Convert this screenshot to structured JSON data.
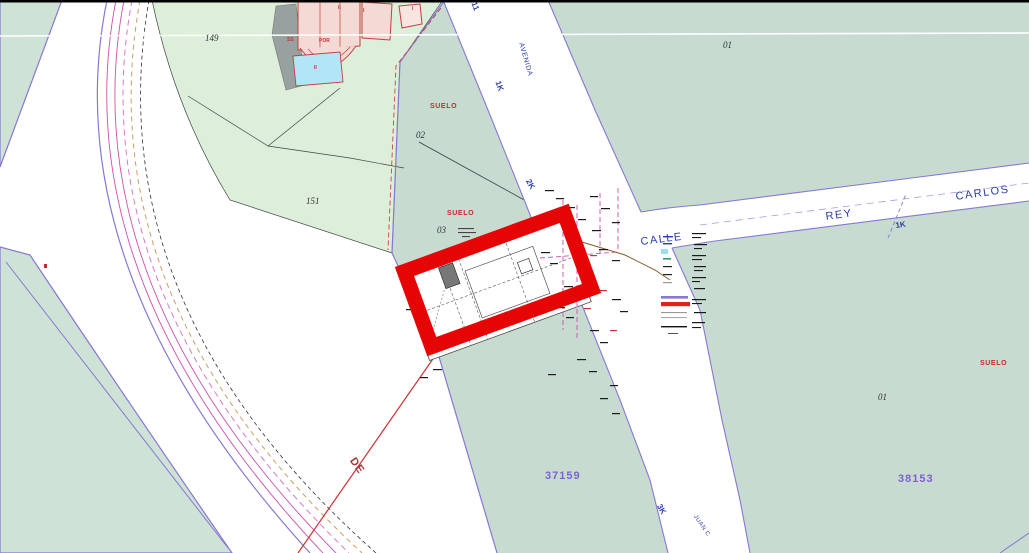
{
  "labels": {
    "p149": "149",
    "p151": "151",
    "p02": "02",
    "p03": "03",
    "p01_top": "01",
    "p01_bottom": "01",
    "suelo_top": "SUELO",
    "suelo_mid": "SUELO",
    "suelo_right": "SUELO",
    "ref_bottom_center": "37159",
    "ref_bottom_right": "38153",
    "avenida": "AVENIDA",
    "calle": "CALLE",
    "rey": "REY",
    "carlos": "CARLOS",
    "de": "DE",
    "juan_c": "JUAN C",
    "k1_avenida": "1K",
    "k1_rey": "1K",
    "k2": "2K",
    "k3": "3K",
    "k11": "11",
    "b_ss": "SS",
    "b_por": "POR",
    "b_ii": "II",
    "b_i": "I",
    "b_i2": "I",
    "b_pool": "II"
  },
  "colors": {
    "highlight_red": "#e60505",
    "road_edge_purple": "#8678d4",
    "boundary_magenta": "#cc4fae",
    "parcel_mint_green": "#ddeeda",
    "parcel_sage_green": "#c8dbd1",
    "street_text_blue": "#2b3ba8",
    "suelo_text_red": "#c22b2b",
    "reference_number_purple": "#7d63cf",
    "building_pink": "#f5d9d4",
    "pool_cyan": "#b2e6f6"
  }
}
